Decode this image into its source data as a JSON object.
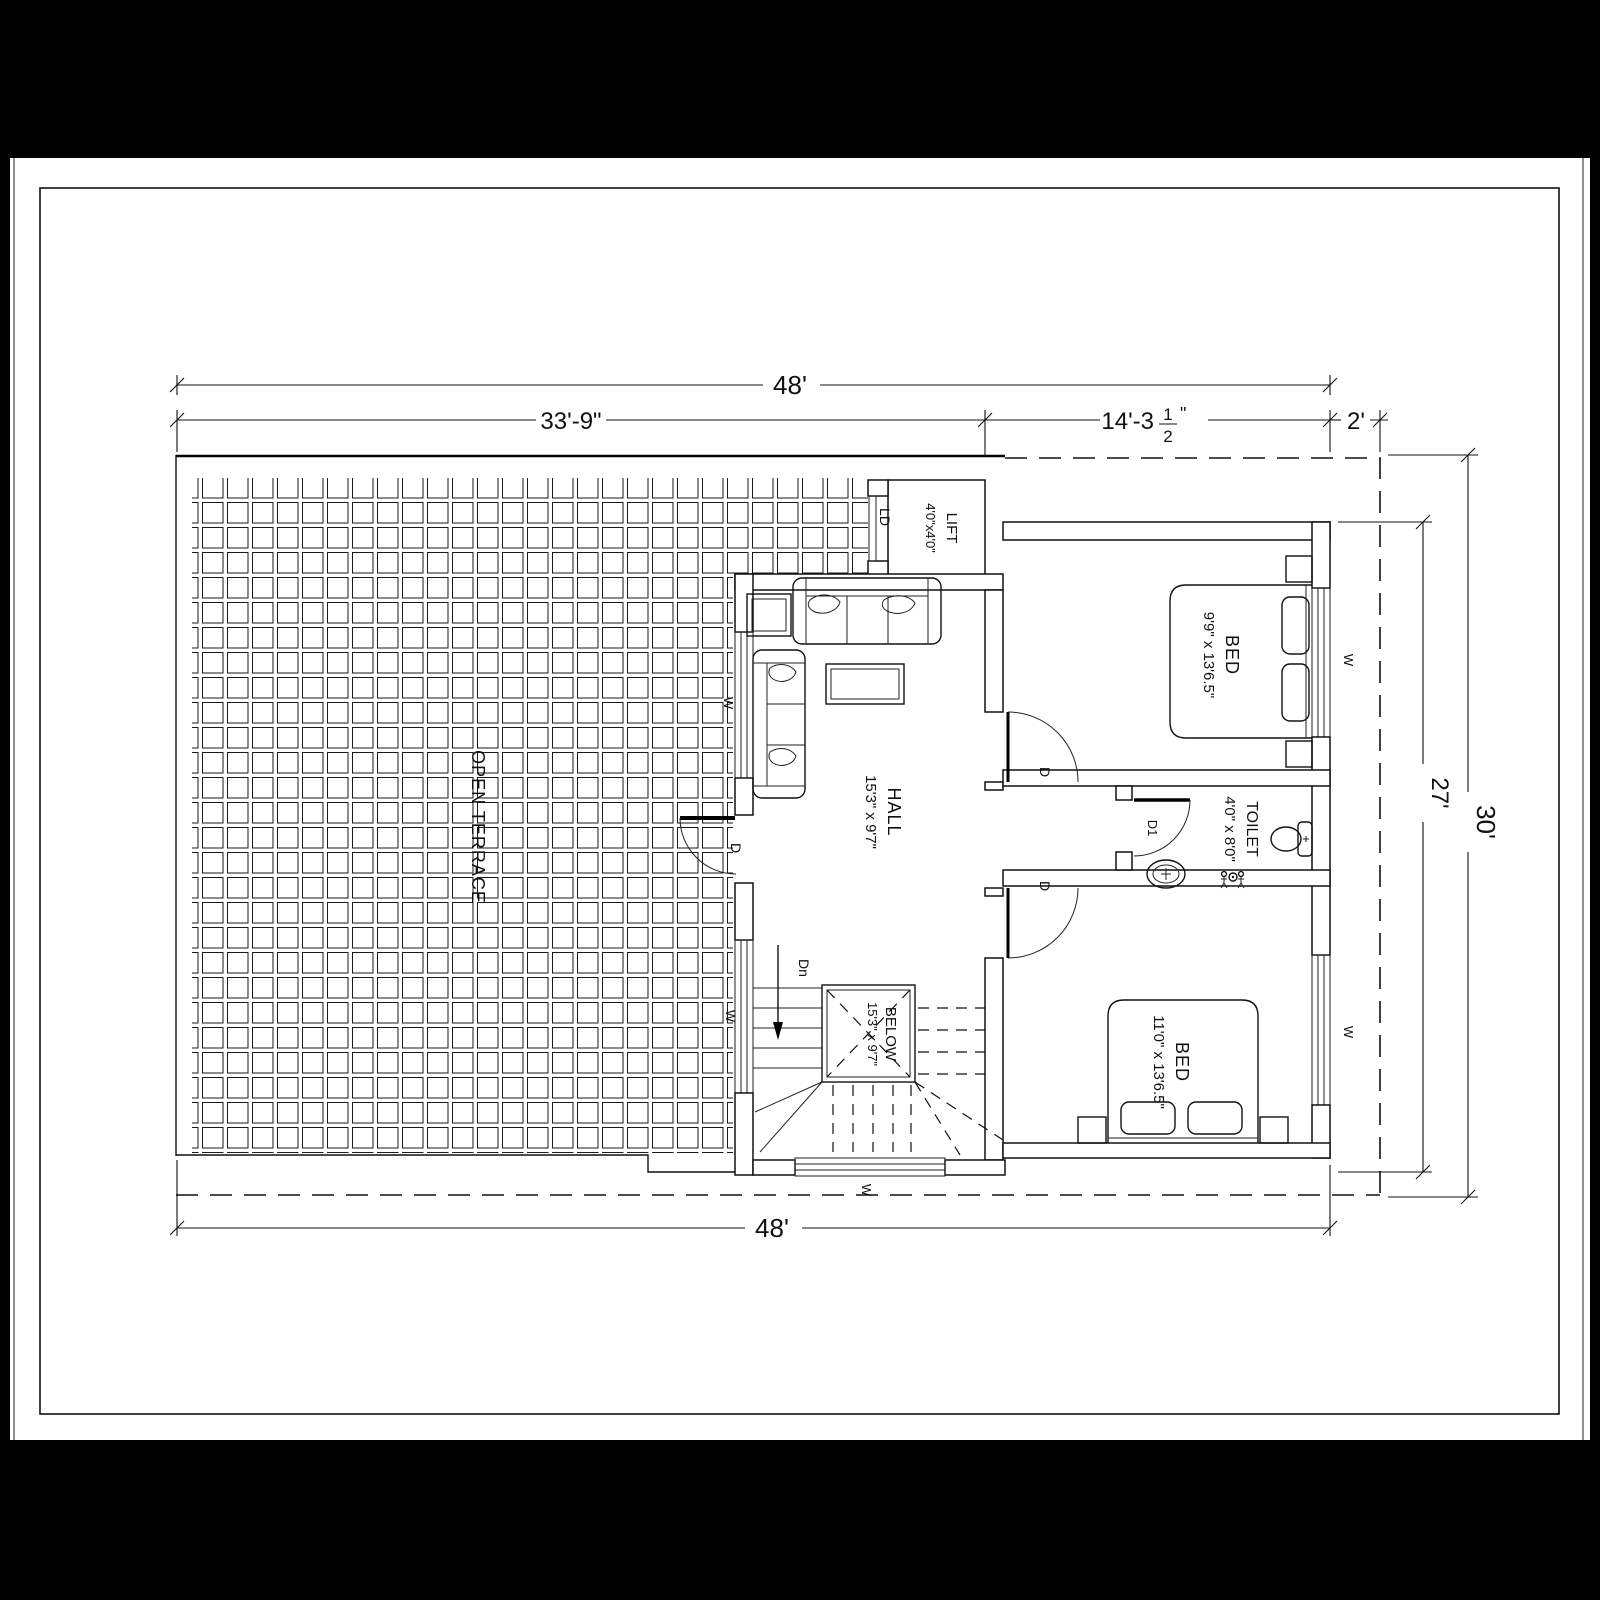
{
  "drawing": {
    "rooms": {
      "terrace": {
        "name": "OPEN TERRACE"
      },
      "hall": {
        "name": "HALL",
        "size": "15'3\" x 9'7\""
      },
      "bed1": {
        "name": "BED",
        "size": "9'9\" x 13'6.5\""
      },
      "bed2": {
        "name": "BED",
        "size": "11'0\" x 13'6.5\""
      },
      "toilet": {
        "name": "TOILET",
        "size": "4'0\" x 8'0\""
      },
      "lift": {
        "name": "LIFT",
        "size": "4'0\"x4'0\""
      },
      "stairwell": {
        "name": "BELOW",
        "size": "15'3\" x 9'7\"",
        "direction": "Dn"
      }
    },
    "labels": {
      "window": "W",
      "door": "D",
      "toilet_door": "D1",
      "lift_door": "LD"
    },
    "dimensions": {
      "top_total": "48'",
      "top_left": "33'-9\"",
      "top_right_main": "14'-3",
      "top_right_frac_num": "1",
      "top_right_frac_den": "2",
      "top_right_suffix": "\"",
      "top_setback": "2'",
      "right_outer": "30'",
      "right_inner": "27'",
      "bottom_total": "48'"
    }
  }
}
